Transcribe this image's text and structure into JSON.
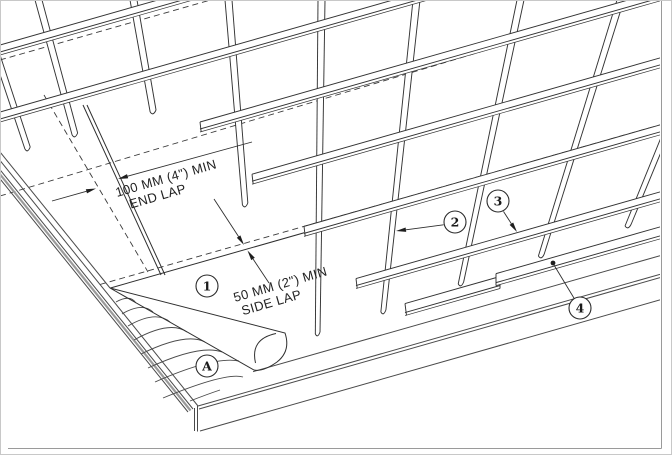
{
  "drawing": {
    "type": "roof-underlayment-batten-detail",
    "annotations": {
      "end_lap": {
        "line1": "100 MM (4\") MIN",
        "line2": "END LAP"
      },
      "side_lap": {
        "line1": "50 MM (2\") MIN",
        "line2": "SIDE LAP"
      }
    },
    "callouts": {
      "c1": {
        "label": "1"
      },
      "c2": {
        "label": "2"
      },
      "c3": {
        "label": "3"
      },
      "c4": {
        "label": "4"
      },
      "cA": {
        "label": "A"
      }
    },
    "colors": {
      "line": "#2f2f2f",
      "fascia": "#4a4a4a",
      "border": "#9a9a9a",
      "background": "#ffffff"
    }
  }
}
